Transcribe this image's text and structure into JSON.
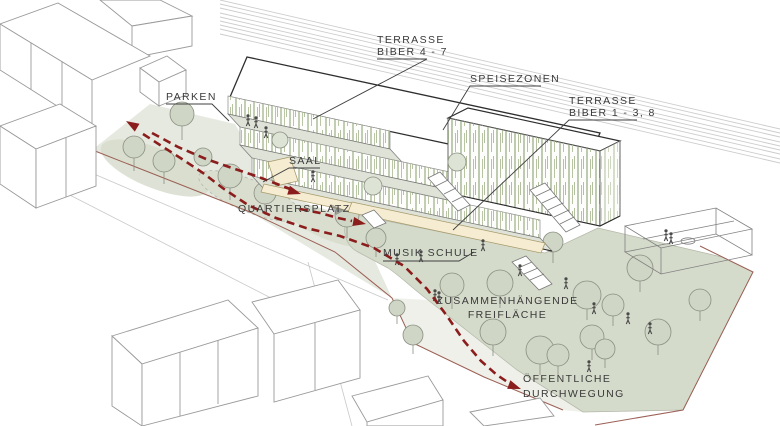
{
  "diagram": {
    "title": "Axonometric site diagram with circulation and open-space annotations",
    "labels": {
      "parken": "PARKEN",
      "terrasse_biber_4_7_line1": "TERRASSE",
      "terrasse_biber_4_7_line2": "BIBER 4 - 7",
      "speisezonen": "SPEISEZONEN",
      "terrasse_biber_1_3_8_line1": "TERRASSE",
      "terrasse_biber_1_3_8_line2": "BIBER 1 - 3, 8",
      "saal": "SAAL",
      "quartiersplatz": "QUARTIERSPLATZ",
      "musik_schule": "MUSIK SCHULE",
      "freiflaeche_line1": "ZUSAMMENHÄNGENDE",
      "freiflaeche_line2": "FREIFLÄCHE",
      "durchwegung_line1": "ÖFFENTLICHE",
      "durchwegung_line2": "DURCHWEGUNG"
    },
    "colors": {
      "path_red": "#8b1d1d",
      "boundary_red_brown": "#9b5f54",
      "green_space": "#d5dbcb",
      "plaza": "#e6e9e0",
      "walkway": "#eef0e9",
      "tree_fill": "#cfd6c5",
      "terrace_tree_fill": "#dde3d5",
      "facade_green": "#8fa477",
      "accent_beige": "#f5ecd2",
      "outline_dark": "#2e2e2e",
      "wireframe_gray": "#9a9a9a",
      "label_text": "#3a3a3a"
    }
  }
}
